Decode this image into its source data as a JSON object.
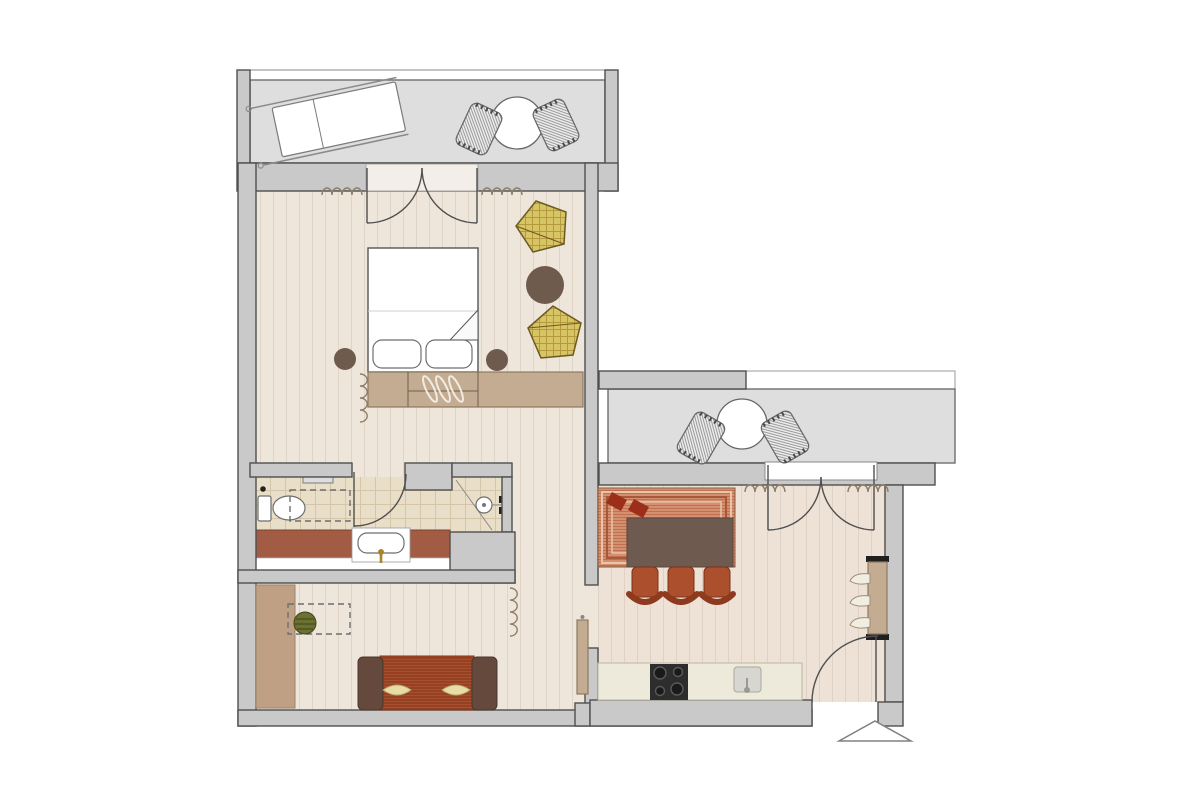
{
  "plan": {
    "type": "apartment-floor-plan",
    "visible_text": [],
    "rooms": [
      {
        "id": "balcony-top"
      },
      {
        "id": "bedroom"
      },
      {
        "id": "bathroom"
      },
      {
        "id": "hall"
      },
      {
        "id": "living-room"
      },
      {
        "id": "kitchen-dining"
      },
      {
        "id": "balcony-right"
      }
    ],
    "furniture": {
      "balcony_top": [
        "sun-lounger",
        "round-table",
        "woven-chair",
        "woven-chair"
      ],
      "bedroom": [
        "double-bed",
        "pillow",
        "pillow",
        "nightstand",
        "nightstand",
        "wardrobe-with-hangers",
        "wicker-pouf",
        "wicker-pouf",
        "round-side-table",
        "curtain"
      ],
      "bathroom": [
        "toilet",
        "towel-rail",
        "reserved-area-dashed",
        "vanity-counter",
        "washbasin",
        "faucet",
        "shower",
        "shower-drain",
        "shower-fixture",
        "swing-door"
      ],
      "living_room": [
        "built-in-closet",
        "potted-plant",
        "reserved-area-dashed",
        "sofa",
        "cushion",
        "cushion"
      ],
      "kitchen_dining": [
        "area-rug",
        "dining-table",
        "dining-chair",
        "dining-chair",
        "dining-chair",
        "kitchen-counter",
        "cooktop",
        "kitchen-sink",
        "sliding-door",
        "coat-rack",
        "french-door",
        "entrance-door",
        "entrance-marker"
      ],
      "balcony_right": [
        "round-table",
        "woven-chair",
        "woven-chair"
      ]
    },
    "symbols": [
      "door-swing-arc",
      "curtain-squiggle",
      "clothes-hanger",
      "entrance-triangle"
    ]
  },
  "colors": {
    "bg": "#ffffff",
    "wall_fill": "#c9c9c9",
    "wall_stroke": "#4f4f4f",
    "balcony_floor": "#dedede",
    "balcony_stroke": "#6e6e6e",
    "floor_main": "#efe6db",
    "floor_kitchen": "#eee2d7",
    "tile_floor": "#e9dfc8",
    "vanity_counter": "#a35c44",
    "tan_furniture": "#c3ac92",
    "tan_stroke": "#8a7a62",
    "brown_round": "#6f5a4e",
    "pouf_fill": "#d7c465",
    "pouf_line": "#b49a3c",
    "pouf_stroke": "#6b5a22",
    "plant_fill": "#6c7031",
    "plant_line": "#464d1c",
    "sofa_fill": "#aa4f2d",
    "sofa_stripe": "#8d3c20",
    "armrest": "#64493c",
    "pillow_cream": "#e7dba6",
    "rug_stripe_a": "#d89b7c",
    "rug_stripe_b": "#c0704f",
    "rug_border": "#a8583a",
    "rug_light": "#e9c5a8",
    "rug_diamond": "#9d2e1a",
    "dining_table": "#6f5a50",
    "chair_fill": "#ab4f2c",
    "chair_back": "#8d3a1e",
    "counter": "#edeadb",
    "cooktop": "#2d2d2d",
    "sink_gray": "#d7d6cf",
    "curtain": "#8d7d68",
    "door_stroke": "#4f4f4f",
    "dash_stroke": "#6f6f6f",
    "faucet_gold": "#a8842e",
    "weave_bg": "#ececec",
    "weave_line": "#9a9a9a",
    "closet_tan": "#bfa084"
  }
}
